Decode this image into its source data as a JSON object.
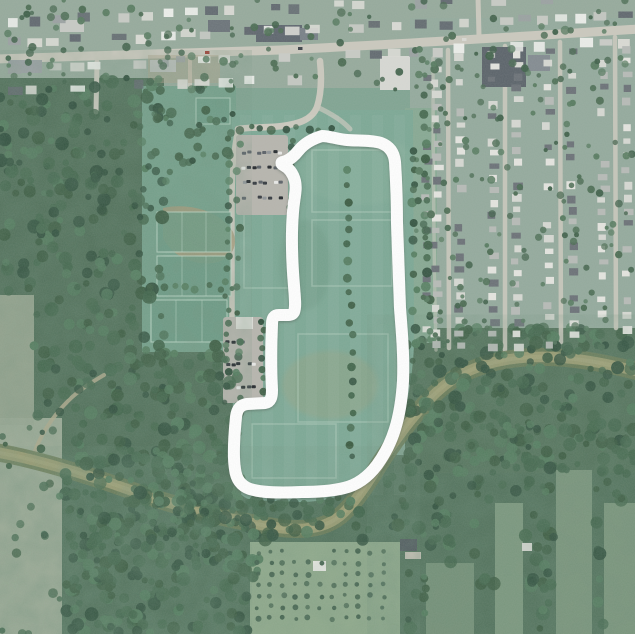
{
  "map": {
    "type": "satellite-aerial-with-gps-route-overlay",
    "route": {
      "color": "#ffffff",
      "stroke_width": 12,
      "path_d": "M322,136 C312,139 304,144 299,150 C295,155 291,159 286,161 L283,162 C281,162 281,164 283,165 C289,168 293,173 295,181 C297,190 294,198 293,212 C291,236 292,262 294,286 C295,299 296,307 294,312 C293,314 291,315 288,315 L279,315 C274,315 272,318 272,324 C271,348 271,372 272,390 C272,397 271,402 265,403 L247,404 C240,405 237,409 236,417 C234,437 233,457 235,469 C236,479 241,486 250,489 C263,493 281,493 301,492 C317,492 332,491 344,488 C357,485 368,477 377,465 C385,454 391,442 395,429 C400,413 402,397 403,381 C404,358 402,333 400,308 C399,283 398,253 397,223 C397,198 396,178 395,162 C394,152 389,146 381,143 C371,140 359,141 347,140 C337,139 329,136 322,136 Z"
    },
    "river": {
      "channel_color": "#9a9b71",
      "bank_color": "#6c7b57",
      "path_d": "M-5,452 C30,458 80,472 130,490 C180,508 235,521 280,528 C305,531 325,528 340,516 C352,506 365,488 380,463 C398,436 420,405 445,385 C468,367 500,358 535,357 C570,356 605,363 640,372"
    },
    "roads": [
      {
        "name": "main-road",
        "d": "M-5,59 C80,57 180,54 280,50 C390,45 510,37 640,29",
        "w": 9
      },
      {
        "name": "cross-street-left",
        "d": "M97,62 L96,112",
        "w": 5
      },
      {
        "name": "driveway-left",
        "d": "M190,60 L190,86",
        "w": 4
      },
      {
        "name": "cross-street-right",
        "d": "M478,-4 L479,36",
        "w": 5
      },
      {
        "name": "park-access-road",
        "d": "M320,61 C322,80 321,95 317,107 C312,120 298,124 282,126 C264,128 248,127 238,129",
        "w": 6.5
      },
      {
        "name": "park-road",
        "d": "M238,129 C233,152 232,176 232,206 L232,352 C232,377 234,393 239,407",
        "w": 5.5
      },
      {
        "name": "park-road-east-spur",
        "d": "M317,107 C330,113 342,120 350,129",
        "w": 5,
        "o": 0.7
      },
      {
        "name": "residential-street-1",
        "d": "M448,50 L449,348",
        "w": 4.5,
        "o": 0.9
      },
      {
        "name": "residential-street-2",
        "d": "M505,46 L505,350",
        "w": 4.5,
        "o": 0.9
      },
      {
        "name": "residential-street-3",
        "d": "M560,42 L561,342",
        "w": 4.5,
        "o": 0.9
      },
      {
        "name": "residential-street-4",
        "d": "M615,37 L616,328",
        "w": 4.5,
        "o": 0.9
      },
      {
        "name": "neighborhood-west-street",
        "d": "M433,58 C433,160 434,260 436,350",
        "w": 3.5,
        "o": 0.55
      },
      {
        "name": "riverside-trail",
        "d": "M33,456 C40,436 52,417 68,401 C79,390 92,382 104,375",
        "w": 4,
        "c": "#b3ab8e",
        "o": 0.85
      }
    ],
    "palette": {
      "field_green": "#7fa391",
      "forest_green": "#4f6e58",
      "road_gray": "#cac8bd",
      "parking_gray": "#b6b4ad",
      "residential_gray_green": "#93a99c",
      "dirt_tan": "#a59878",
      "route_white": "#ffffff"
    }
  }
}
